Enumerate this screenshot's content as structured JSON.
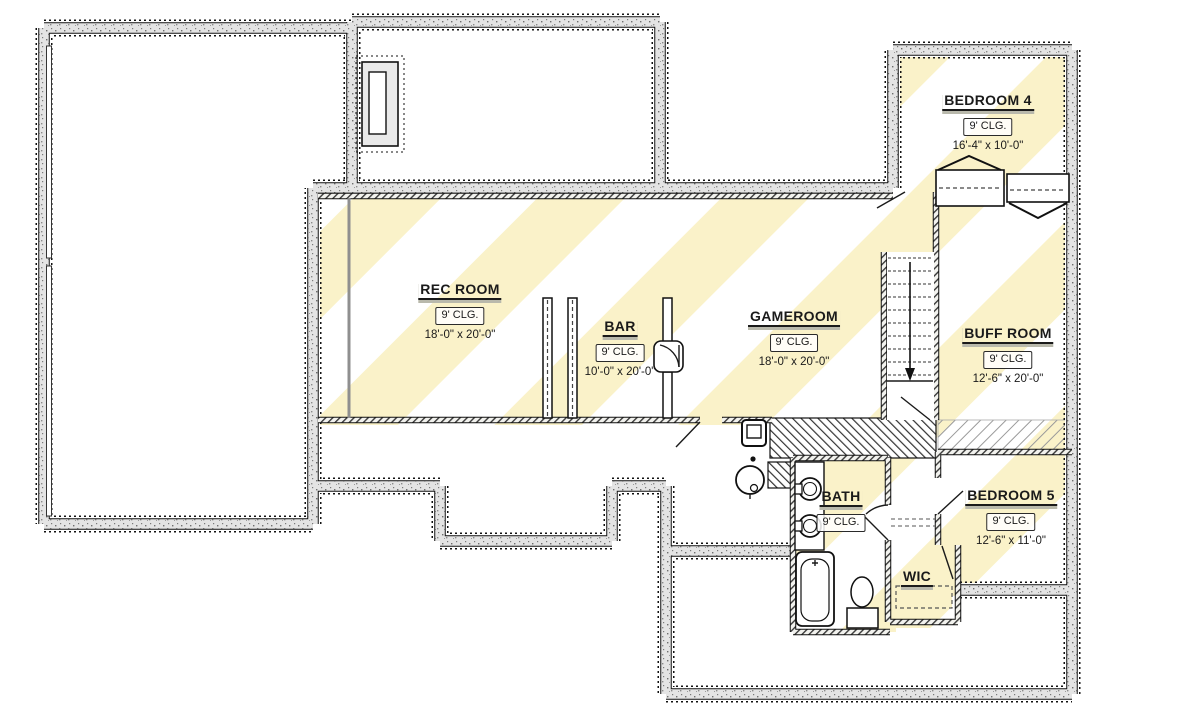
{
  "plan": {
    "type": "basement-floor-plan",
    "rooms": [
      {
        "name": "BEDROOM 4",
        "ceiling": "9' CLG.",
        "dims": "16'-4\" x 10'-0\""
      },
      {
        "name": "REC ROOM",
        "ceiling": "9' CLG.",
        "dims": "18'-0\" x 20'-0\""
      },
      {
        "name": "BAR",
        "ceiling": "9' CLG.",
        "dims": "10'-0\" x 20'-0\""
      },
      {
        "name": "GAMEROOM",
        "ceiling": "9' CLG.",
        "dims": "18'-0\" x 20'-0\""
      },
      {
        "name": "BUFF ROOM",
        "ceiling": "9' CLG.",
        "dims": "12'-6\" x 20'-0\""
      },
      {
        "name": "BATH",
        "ceiling": "9' CLG.",
        "dims": ""
      },
      {
        "name": "BEDROOM 5",
        "ceiling": "9' CLG.",
        "dims": "12'-6\" x 11'-0\""
      },
      {
        "name": "WIC",
        "ceiling": "",
        "dims": ""
      }
    ],
    "colors": {
      "finished_area_stripe": "#faf2c9",
      "wall_fill": "#e4e4e4",
      "line": "#1a1a1a"
    }
  }
}
